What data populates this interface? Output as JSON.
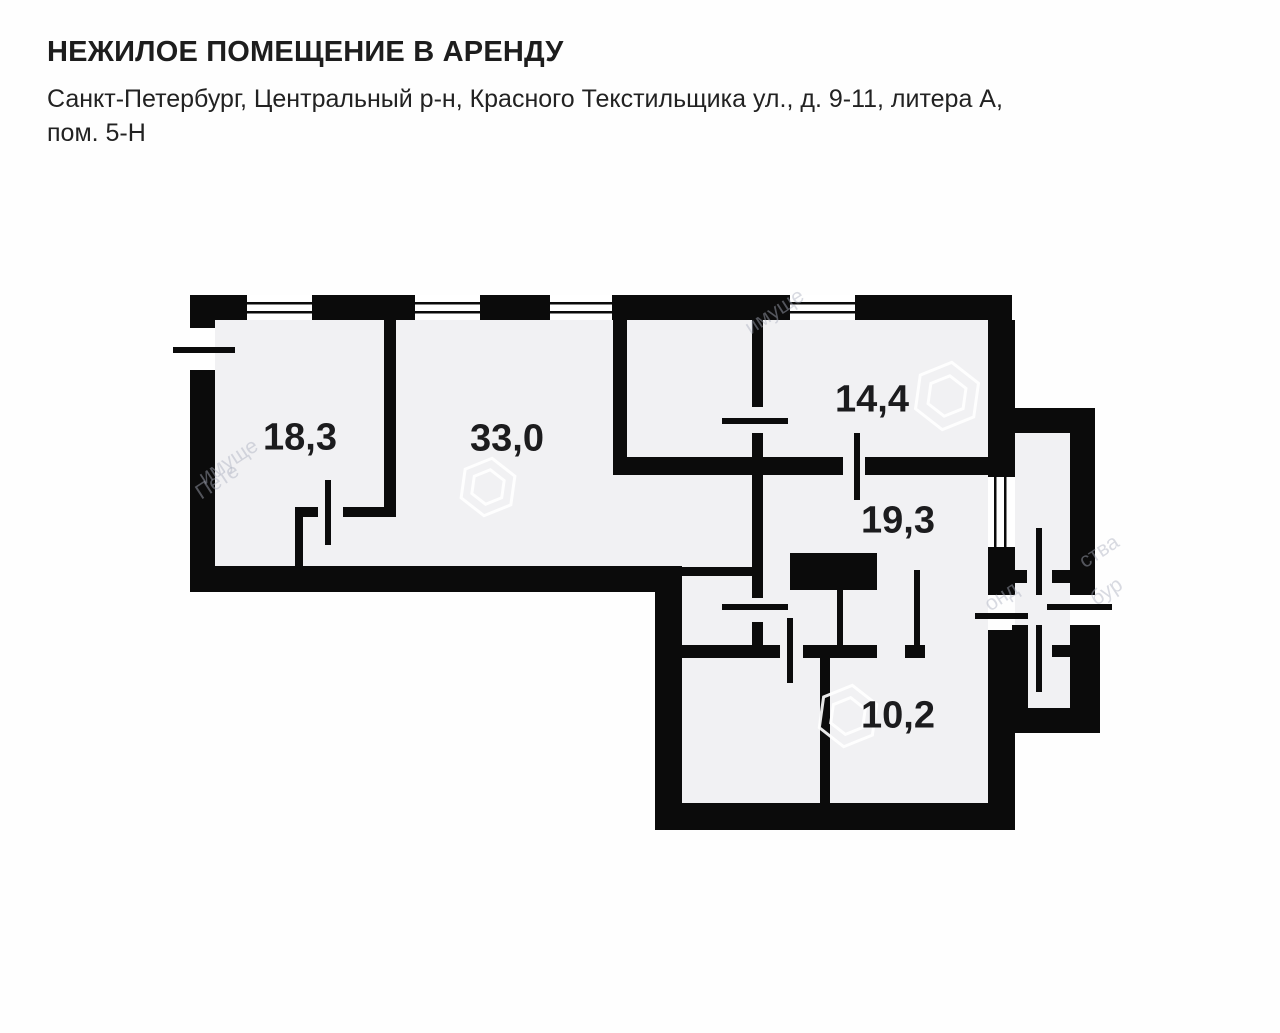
{
  "header": {
    "title": "НЕЖИЛОЕ ПОМЕЩЕНИЕ В АРЕНДУ",
    "address_line1": "Санкт-Петербург, Центральный р-н, Красного Текстильщика ул., д. 9-11, литера А,",
    "address_line2": "пом. 5-Н"
  },
  "floor_plan": {
    "rooms": [
      {
        "area_m2": "18,3",
        "x": 300,
        "y": 438
      },
      {
        "area_m2": "33,0",
        "x": 507,
        "y": 439
      },
      {
        "area_m2": "14,4",
        "x": 872,
        "y": 400
      },
      {
        "area_m2": "19,3",
        "x": 898,
        "y": 521
      },
      {
        "area_m2": "10,2",
        "x": 898,
        "y": 716
      }
    ],
    "watermark": {
      "logos": [
        {
          "x": 488,
          "y": 487,
          "r": 29
        },
        {
          "x": 947,
          "y": 396,
          "r": 34
        },
        {
          "x": 848,
          "y": 716,
          "r": 31
        }
      ],
      "texts": [
        {
          "text": "имуще",
          "x": 742,
          "y": 300,
          "rot": -33
        },
        {
          "text": "имуще",
          "x": 196,
          "y": 450,
          "rot": -33
        },
        {
          "text": "Пете",
          "x": 194,
          "y": 470,
          "rot": -33
        },
        {
          "text": "ства",
          "x": 1078,
          "y": 540,
          "rot": -33
        },
        {
          "text": "бур",
          "x": 1090,
          "y": 580,
          "rot": -33
        },
        {
          "text": "онд",
          "x": 984,
          "y": 585,
          "rot": -33
        }
      ]
    },
    "colors": {
      "wall": "#0b0b0b",
      "interior": "#f1f1f3",
      "page": "#fefefe",
      "label_text": "#1c1c1e"
    }
  }
}
